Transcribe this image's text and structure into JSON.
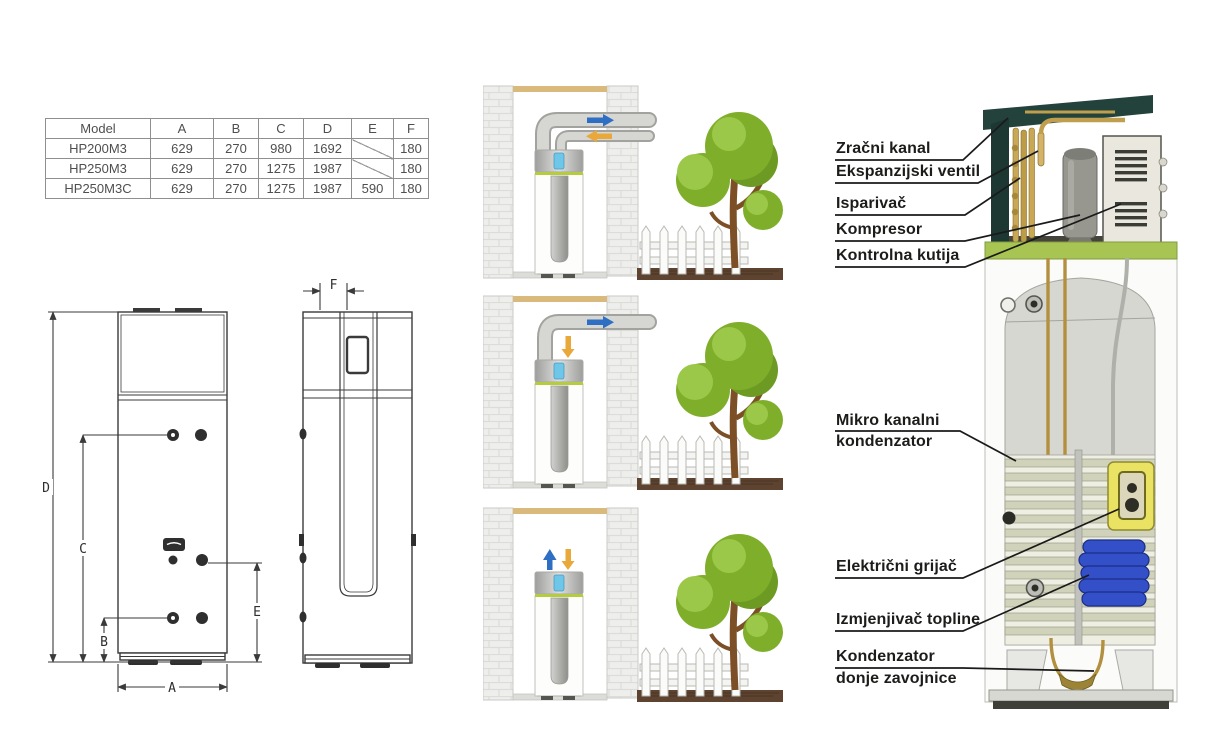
{
  "spec_table": {
    "headers": [
      "Model",
      "A",
      "B",
      "C",
      "D",
      "E",
      "F"
    ],
    "rows": [
      {
        "model": "HP200M3",
        "A": "629",
        "B": "270",
        "C": "980",
        "D": "1692",
        "E": "",
        "F": "180"
      },
      {
        "model": "HP250M3",
        "A": "629",
        "B": "270",
        "C": "1275",
        "D": "1987",
        "E": "",
        "F": "180"
      },
      {
        "model": "HP250M3C",
        "A": "629",
        "B": "270",
        "C": "1275",
        "D": "1987",
        "E": "590",
        "F": "180"
      }
    ]
  },
  "dimension_labels": {
    "A": "A",
    "B": "B",
    "C": "C",
    "D": "D",
    "E": "E",
    "F": "F"
  },
  "callouts": [
    {
      "text": "Zračni kanal"
    },
    {
      "text": "Ekspanzijski ventil"
    },
    {
      "text": "Isparivač"
    },
    {
      "text": "Kompresor"
    },
    {
      "text": "Kontrolna kutija"
    },
    {
      "line1": "Mikro kanalni",
      "line2": "kondenzator"
    },
    {
      "text": "Električni grijač"
    },
    {
      "text": "Izmjenjivač topline"
    },
    {
      "line1": "Kondenzator",
      "line2": "donje zavojnice"
    }
  ],
  "colors": {
    "line": "#3a3a3a",
    "table_border": "#8f8f8f",
    "table_text": "#4f4f4f",
    "label_text": "#1c1c1a",
    "duct_teal": "#24423c",
    "brass": "#bf9f4e",
    "plate_green": "#a8c553",
    "ring_green": "#b5cc3e",
    "coil_blue": "#3450c8",
    "heater_yellow": "#e9e263",
    "arrow_blue": "#2e6fc4",
    "arrow_orange": "#e8a93a",
    "tree_green": "#7fae2a",
    "tree_green_light": "#9cc84a",
    "tree_green_dark": "#6d9a22",
    "trunk_brown": "#7c4f27",
    "ground_brown": "#5d4330",
    "wall_stone": "#eeeeec",
    "beam_tan": "#d9b97c",
    "tank_gray": "#d7d7d1"
  }
}
